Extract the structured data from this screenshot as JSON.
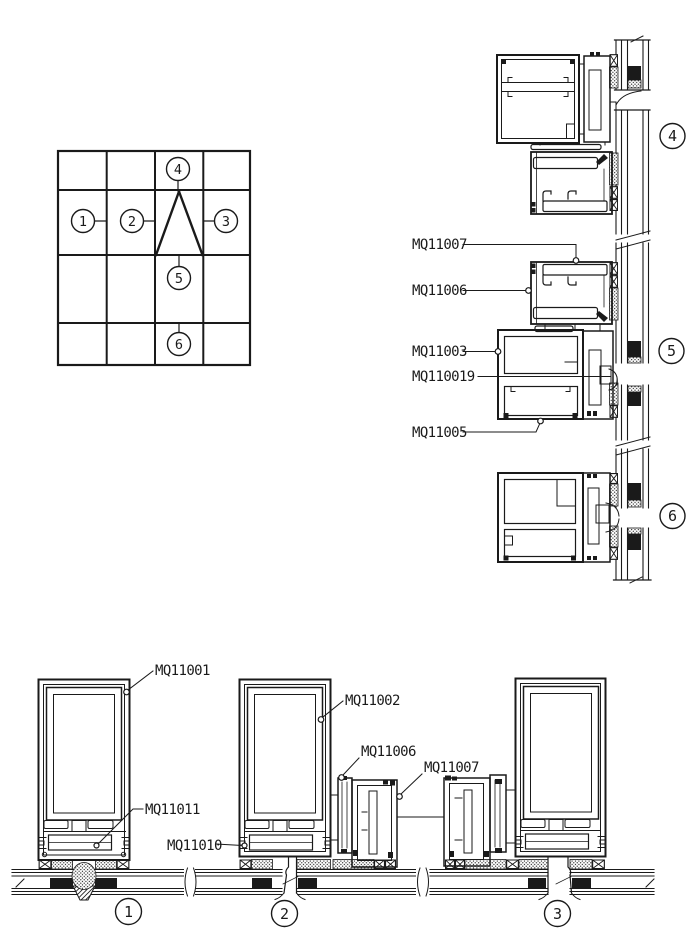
{
  "colors": {
    "line": "#1a1a1a",
    "background": "#ffffff"
  },
  "key_plan": {
    "markers": {
      "m1": "1",
      "m2": "2",
      "m3": "3",
      "m4": "4",
      "m5": "5",
      "m6": "6"
    }
  },
  "right_details": {
    "labels": {
      "mq11007": "MQ11007",
      "mq11006": "MQ11006",
      "mq11003": "MQ11003",
      "mq110019": "MQ110019",
      "mq11005": "MQ11005"
    },
    "markers": {
      "m4": "4",
      "m5": "5",
      "m6": "6"
    }
  },
  "bottom_details": {
    "labels": {
      "mq11001": "MQ11001",
      "mq11002": "MQ11002",
      "mq11006": "MQ11006",
      "mq11007": "MQ11007",
      "mq11011": "MQ11011",
      "mq11010": "MQ11010"
    },
    "markers": {
      "m1": "1",
      "m2": "2",
      "m3": "3"
    }
  }
}
